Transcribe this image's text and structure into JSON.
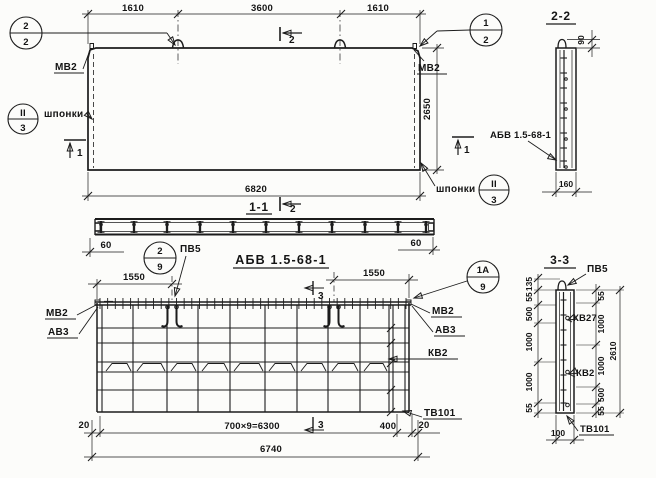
{
  "facade": {
    "dim_1610_left": "1610",
    "dim_3600": "3600",
    "dim_1610_right": "1610",
    "dim_2650": "2650",
    "dim_6820": "6820",
    "label_mv2_left": "МВ2",
    "label_mv2_right": "МВ2",
    "label_shponki_left": "шпонки",
    "label_shponki_right": "шпонки",
    "callout_2_2": {
      "top": "2",
      "bottom": "2"
    },
    "callout_1_2": {
      "top": "1",
      "bottom": "2"
    },
    "node_left": {
      "top": "II",
      "bottom": "3"
    },
    "node_right": {
      "top": "II",
      "bottom": "3"
    },
    "mark_1_left": "1",
    "mark_1_right": "1",
    "mark_2_top": "2"
  },
  "section_1_1": {
    "title": "1-1",
    "mark_2": "2",
    "dim_60_left": "60",
    "dim_60_right": "60"
  },
  "assembly_title": "АБВ 1.5-68-1",
  "section_2_2": {
    "title": "2-2",
    "dim_90": "90",
    "dim_160": "160",
    "label_abv": "АБВ 1.5-68-1"
  },
  "mesh": {
    "dim_1550_left": "1550",
    "dim_1550_right": "1550",
    "callout_2_9": {
      "top": "2",
      "bottom": "9"
    },
    "callout_1a_9": {
      "top": "1А",
      "bottom": "9"
    },
    "label_pv5": "ПВ5",
    "label_mv2_left": "МВ2",
    "label_av3_left": "АВ3",
    "label_mv2_right": "МВ2",
    "label_av3_right": "АВ3",
    "label_kv2": "КВ2",
    "label_tv101": "ТВ101",
    "mark_3_top": "3",
    "mark_3_bottom": "3",
    "dim_20_left": "20",
    "dim_spacing": "700×9=6300",
    "dim_400": "400",
    "dim_20_right": "20",
    "dim_6740": "6740"
  },
  "section_3_3": {
    "title": "3-3",
    "label_pv5": "ПВ5",
    "label_kv27": "КВ27",
    "label_kv2": "КВ2",
    "label_tv101": "ТВ101",
    "dims_left": [
      "135",
      "55",
      "500",
      "1000",
      "1000",
      "55"
    ],
    "dims_right": [
      "55",
      "1000",
      "1000",
      "500",
      "55"
    ],
    "dim_total": "2610",
    "dim_100": "100"
  }
}
